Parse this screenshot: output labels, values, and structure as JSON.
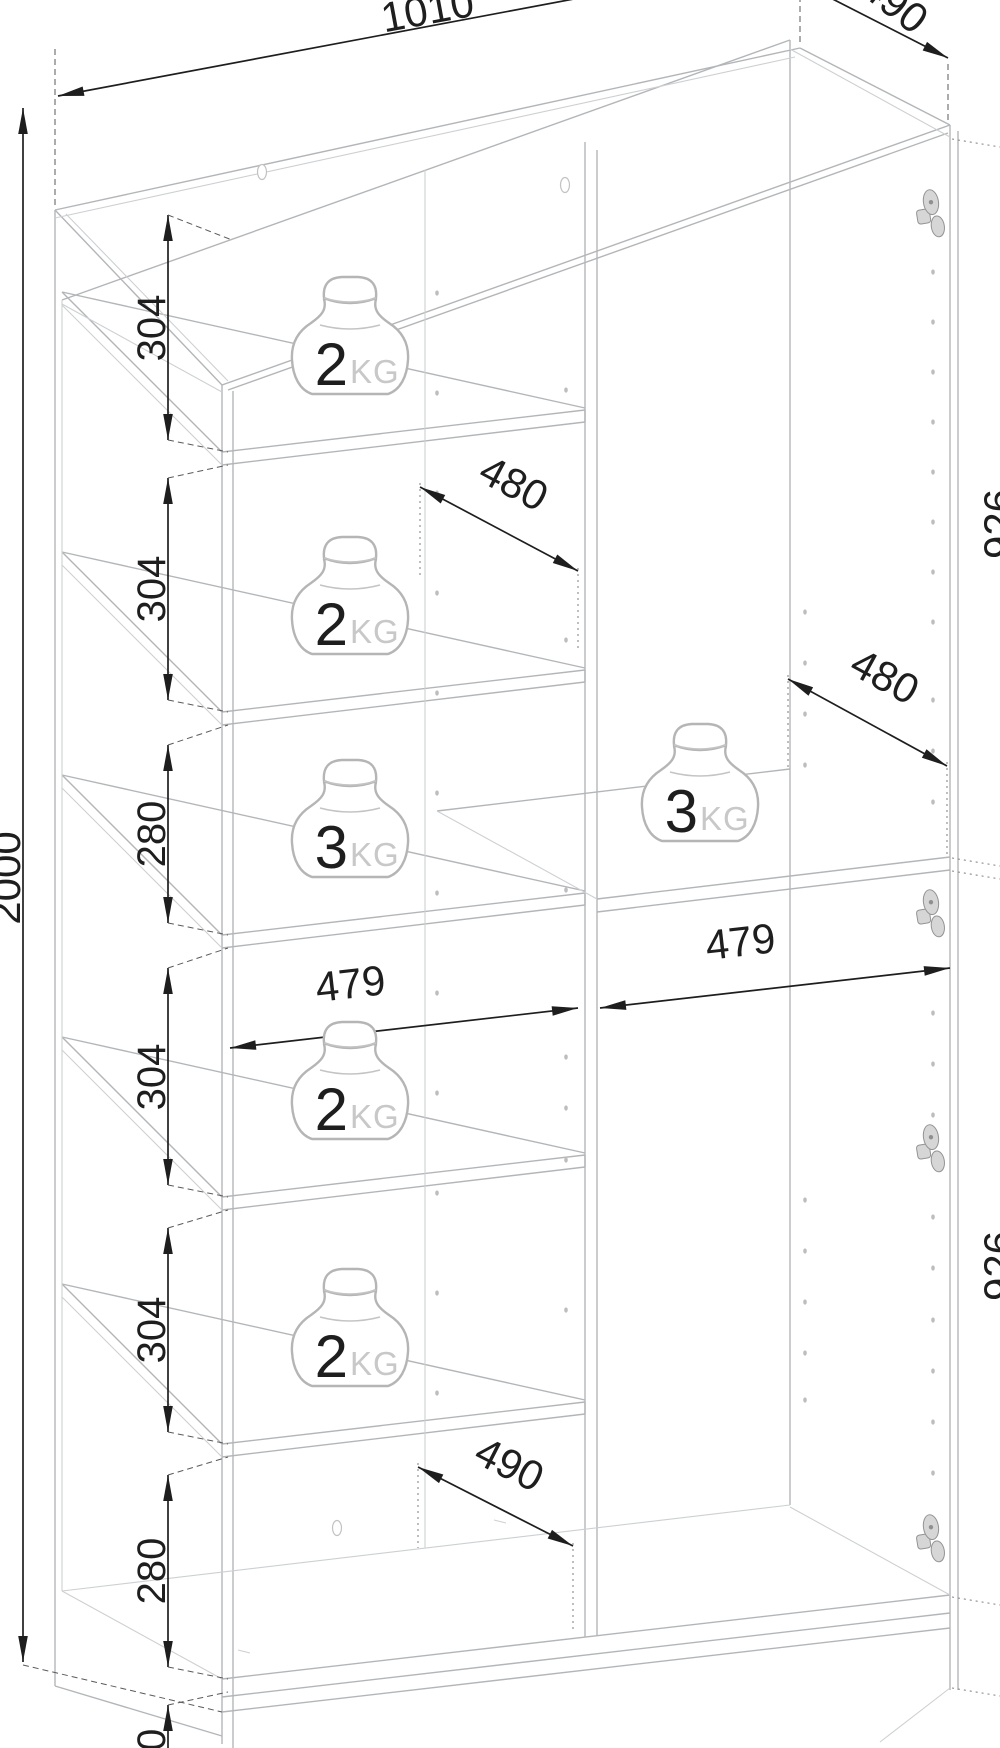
{
  "diagram": {
    "dims": {
      "width_top": "1010",
      "depth_top": "490",
      "height_total": "2000",
      "left_chain": [
        "304",
        "304",
        "280",
        "304",
        "304",
        "280",
        "100"
      ],
      "shelf_depth_upper": "480",
      "shelf_depth_right": "480",
      "inner_width_left": "479",
      "inner_width_right": "479",
      "depth_bottom": "490",
      "right_heights": [
        "926",
        "926"
      ]
    },
    "weights": [
      {
        "value": "2",
        "unit": "KG"
      },
      {
        "value": "2",
        "unit": "KG"
      },
      {
        "value": "3",
        "unit": "KG"
      },
      {
        "value": "2",
        "unit": "KG"
      },
      {
        "value": "2",
        "unit": "KG"
      },
      {
        "value": "3",
        "unit": "KG"
      }
    ],
    "colors": {
      "line": "#b3b6b9",
      "line_light": "#cdd0d2",
      "dimension": "#1e1e1e",
      "muted_text": "#c8c8c8",
      "hardware": "#9a9a9a"
    }
  }
}
